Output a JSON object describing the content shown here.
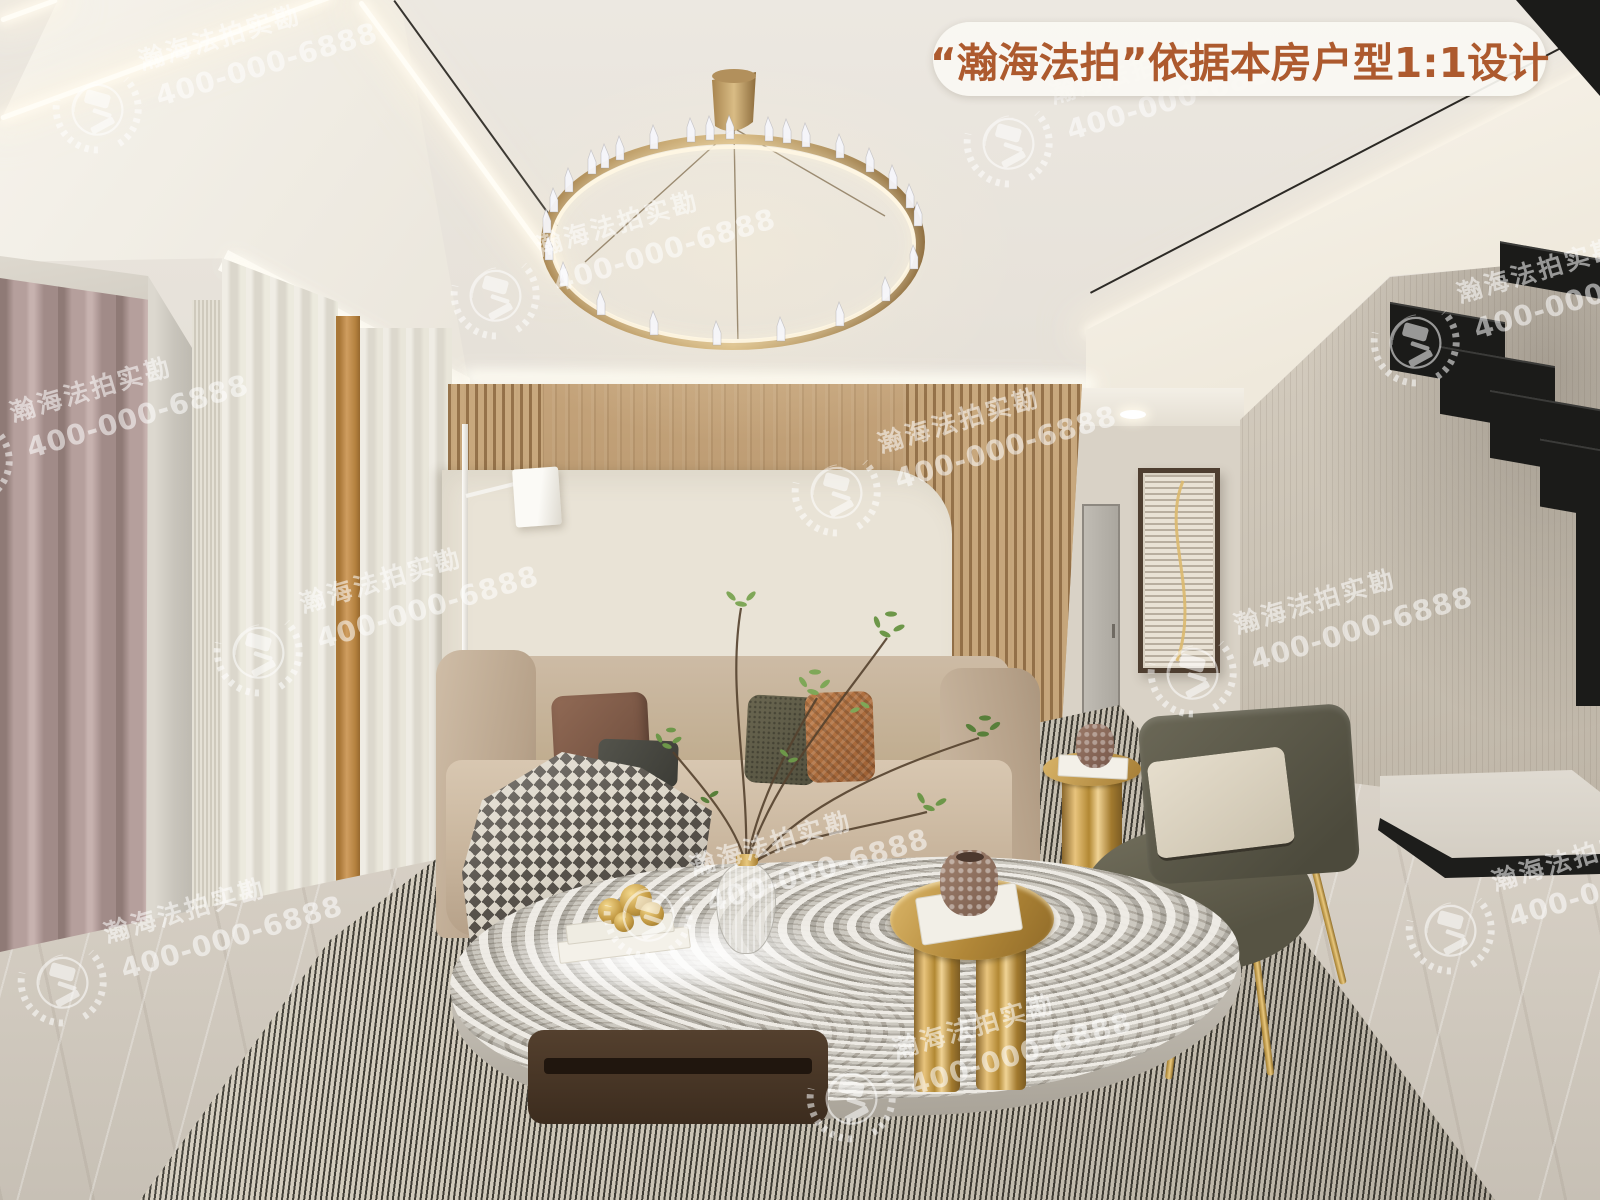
{
  "banner": {
    "text": "“瀚海法拍”依据本房户型1:1设计",
    "text_color": "#ad5a2e",
    "background_color": "rgba(250,248,243,0.92)"
  },
  "watermark": {
    "brand_text": "瀚海法拍实勘",
    "phone": "400-000-6888",
    "color": "#ffffff",
    "opacity": 0.55,
    "rotation_deg": -16.5,
    "logo_icon": "laurel-wreath-gavel-emblem",
    "positions": [
      [
        51,
        38
      ],
      [
        962,
        72
      ],
      [
        449,
        224
      ],
      [
        1369,
        271
      ],
      [
        -78,
        390
      ],
      [
        790,
        421
      ],
      [
        212,
        581
      ],
      [
        1146,
        602
      ],
      [
        602,
        844
      ],
      [
        16,
        911
      ],
      [
        1404,
        859
      ],
      [
        805,
        1027
      ]
    ]
  }
}
